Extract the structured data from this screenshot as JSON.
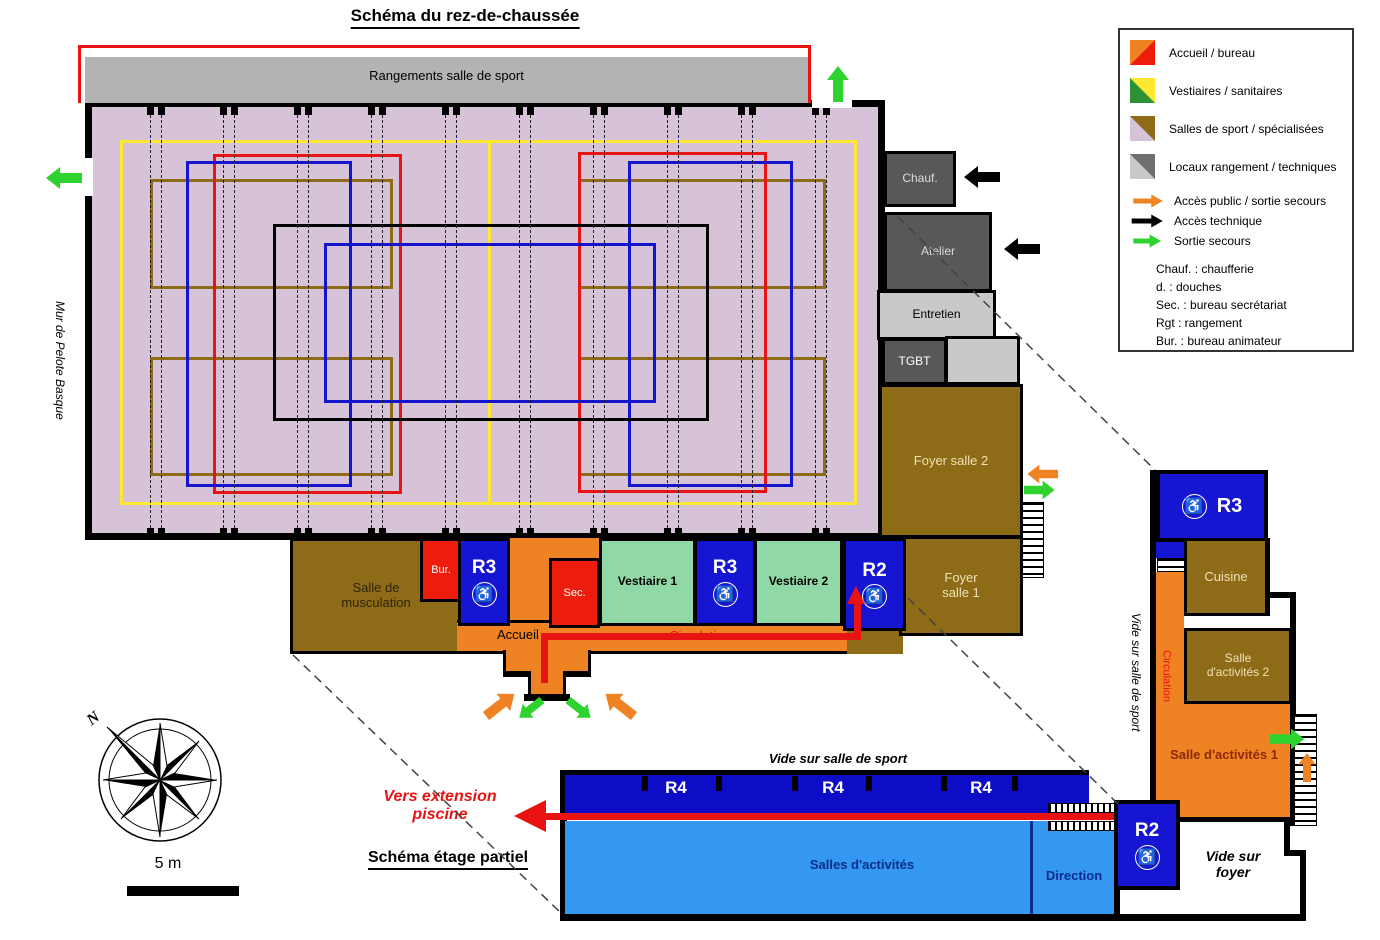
{
  "titles": {
    "ground": "Schéma du rez-de-chaussée",
    "upper": "Schéma étage partiel",
    "extension": "Vers extension piscine"
  },
  "scale_label": "5 m",
  "north_label": "N",
  "icons": {
    "wheelchair": "♿"
  },
  "ground": {
    "rangements": "Rangements salle de sport",
    "mur_pelote": "Mur de Pelote Basque",
    "chauf": "Chauf.",
    "atelier": "Atelier",
    "entretien": "Entretien",
    "tgbt": "TGBT",
    "foyer2": "Foyer salle 2",
    "foyer1": "Foyer salle 1",
    "musculation": "Salle de musculation",
    "bur": "Bur.",
    "r3_hall": "R3",
    "sec": "Sec.",
    "accueil": "Accueil",
    "vestiaire1": "Vestiaire 1",
    "r3_vestiaires": "R3",
    "vestiaire2": "Vestiaire 2",
    "r2": "R2",
    "circulation": "Circulation"
  },
  "upper": {
    "vide_salle_sport": "Vide sur salle de sport",
    "r4": "R4",
    "salles_activites": "Salles d'activités",
    "direction": "Direction",
    "r2": "R2",
    "vide_foyer": "Vide sur foyer",
    "r3": "R3",
    "cuisine": "Cuisine",
    "salle_activites_2": "Salle d'activités 2",
    "salle_activites_1": "Salle d'activités 1",
    "circulation": "Circulation",
    "vide_salle_sport_side": "Vide sur salle de sport"
  },
  "legend": {
    "areas": [
      {
        "label": "Accueil / bureau",
        "color_a": "#ef8222",
        "color_b": "#ee1c0c"
      },
      {
        "label": "Vestiaires / sanitaires",
        "color_a": "#2e9234",
        "color_b": "#ffe930"
      },
      {
        "label": "Salles de sport / spécialisées",
        "color_a": "#d7c3d8",
        "color_b": "#8e6c17"
      },
      {
        "label": "Locaux rangement / techniques",
        "color_a": "#c9c9c9",
        "color_b": "#6e6e6e"
      }
    ],
    "arrows": [
      {
        "label": "Accès public / sortie secours",
        "color": "#ef8222"
      },
      {
        "label": "Accès technique",
        "color": "#000000"
      },
      {
        "label": "Sortie secours",
        "color": "#2fd32f"
      }
    ],
    "abbreviations": [
      "Chauf. : chaufferie",
      "d. : douches",
      "Sec. : bureau secrétariat",
      "Rgt : rangement",
      "Bur. : bureau animateur"
    ]
  },
  "colors": {
    "wall": "#000000",
    "hall_floor": "#d7c3d8",
    "storage_gray": "#b3b3b3",
    "dark_gray_room": "#585858",
    "light_gray_room": "#c9c9c9",
    "brown_room": "#8e6c17",
    "red_room": "#ee1c0c",
    "blue_room": "#1616d2",
    "light_blue_room": "#3598f0",
    "green_room": "#90d8a5",
    "orange_room": "#ef8222",
    "court_yellow": "#ffe930",
    "court_red": "#e81313",
    "court_blue": "#1414cd",
    "court_brown": "#8e6c17",
    "path_red": "#e81313",
    "arrow_green": "#2fd32f"
  }
}
